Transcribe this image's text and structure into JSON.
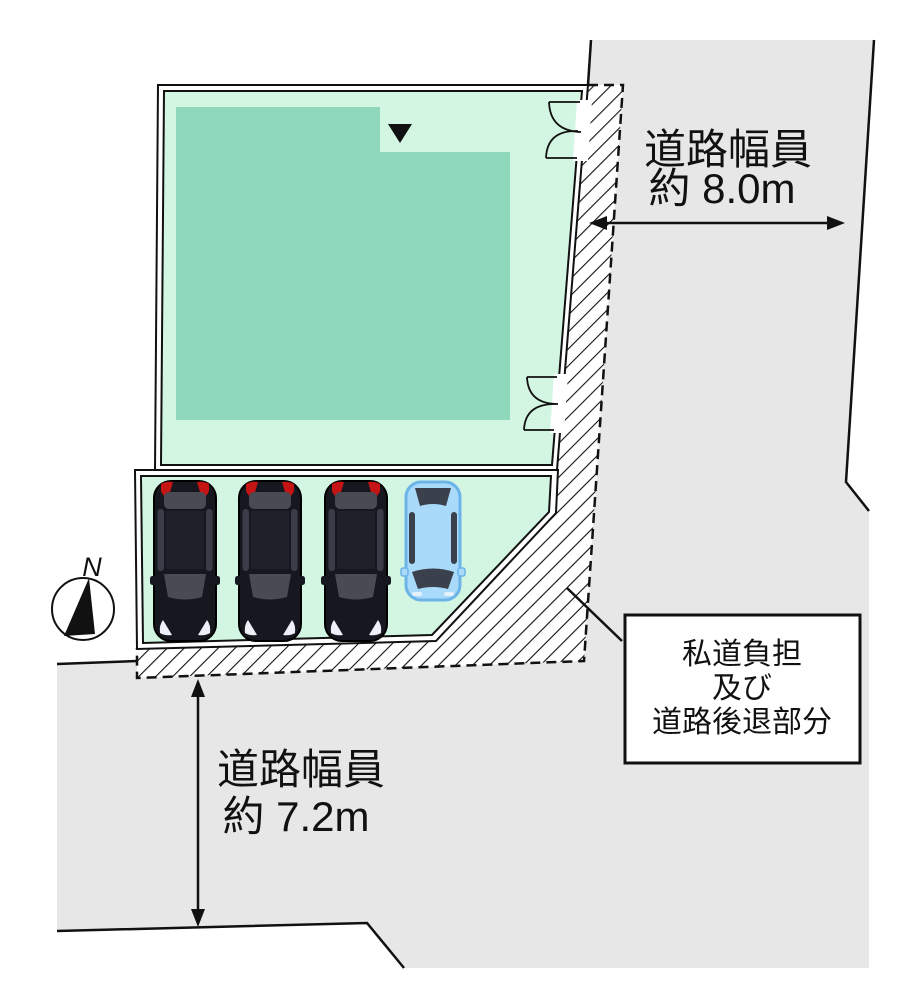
{
  "labels": {
    "road_width_right": {
      "line1": "道路幅員",
      "line2": "約 8.0m"
    },
    "road_width_bottom": {
      "line1": "道路幅員",
      "line2": "約 7.2m"
    },
    "setback_box": {
      "line1": "私道負担",
      "line2": "及び",
      "line3": "道路後退部分"
    }
  },
  "compass": {
    "north_label": "N"
  },
  "parking": {
    "car_count": 4,
    "dark_car_count": 3,
    "highlight_car_count": 1
  },
  "colors": {
    "road_gray": "#e7e7e7",
    "parcel_green": "#d3f6e3",
    "building_green": "#8fd8bc",
    "hatch_bg": "#ffffff",
    "line_black": "#111111",
    "dark_car_body": "#17171f",
    "car_window": "#4a4a55",
    "taillight_red": "#c41414",
    "headlight_white": "#eef0f8",
    "blue_car_body": "#a9daf9",
    "blue_car_outline": "#6cb4e8",
    "blue_car_window": "#3a414d"
  }
}
